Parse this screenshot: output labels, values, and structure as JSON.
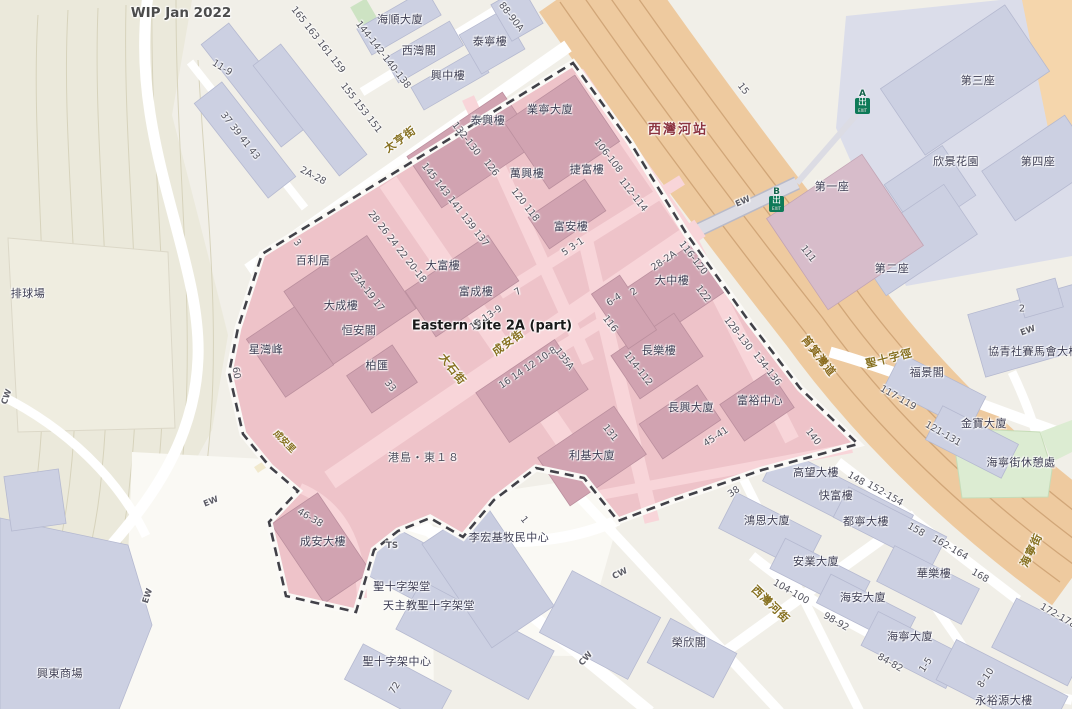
{
  "map": {
    "note": "WIP Jan 2022",
    "site_area": "Eastern Site 2A (part)",
    "station": {
      "name": "西灣河站",
      "exit_glyph": "出",
      "exit_caption": "EXIT",
      "exits": [
        {
          "letter": "A",
          "x": 855,
          "y": 90
        },
        {
          "letter": "B",
          "x": 769,
          "y": 188
        }
      ]
    },
    "colors": {
      "zone_fill": "#eec3c9",
      "zone_building": "#d1a3b1",
      "zone_road": "#f8d5d9",
      "building_lavender": "#ccd0e2",
      "building_mauve": "#d7bcca",
      "corridor_orange": "#eeca9f",
      "park_green": "#dcecd2",
      "hill_beige": "#ebe9db",
      "boundary_dash": "#414148",
      "station_text": "#8c3440",
      "street_text": "#86701f",
      "exit_green": "#0e7a58"
    },
    "labels": [
      {
        "t": "WIP Jan 2022",
        "x": 181,
        "y": 13,
        "c": "note",
        "n": "map-note-wip"
      },
      {
        "t": "11-9",
        "x": 222,
        "y": 68,
        "r": 32,
        "c": "num"
      },
      {
        "t": "165 163 161 159",
        "x": 318,
        "y": 40,
        "r": 52,
        "c": "num"
      },
      {
        "t": "155 153 151",
        "x": 361,
        "y": 108,
        "r": 52,
        "c": "num"
      },
      {
        "t": "37 39 41 43",
        "x": 240,
        "y": 136,
        "r": 52,
        "c": "num"
      },
      {
        "t": "2A-28",
        "x": 313,
        "y": 176,
        "r": 28,
        "c": "num"
      },
      {
        "t": "排球場",
        "x": 28,
        "y": 293,
        "c": "bldg",
        "n": "volleyball-court-label"
      },
      {
        "t": "海順大廈",
        "x": 400,
        "y": 19,
        "c": "bldg"
      },
      {
        "t": "西灣閣",
        "x": 419,
        "y": 50,
        "c": "bldg"
      },
      {
        "t": "泰寧樓",
        "x": 490,
        "y": 41,
        "c": "bldg"
      },
      {
        "t": "興中樓",
        "x": 448,
        "y": 75,
        "c": "bldg"
      },
      {
        "t": "88-90A",
        "x": 511,
        "y": 17,
        "r": 52,
        "c": "num"
      },
      {
        "t": "144-142-140-138",
        "x": 383,
        "y": 55,
        "r": 52,
        "c": "num"
      },
      {
        "t": "太亨街",
        "x": 400,
        "y": 139,
        "r": -36,
        "c": "street",
        "n": "street-tai-hang"
      },
      {
        "t": "泰興樓",
        "x": 488,
        "y": 120,
        "c": "bldg"
      },
      {
        "t": "業寧大廈",
        "x": 550,
        "y": 109,
        "c": "bldg"
      },
      {
        "t": "萬興樓",
        "x": 527,
        "y": 173,
        "c": "bldg"
      },
      {
        "t": "捷富樓",
        "x": 587,
        "y": 169,
        "c": "bldg"
      },
      {
        "t": "富安樓",
        "x": 571,
        "y": 226,
        "c": "bldg"
      },
      {
        "t": "132-130",
        "x": 466,
        "y": 139,
        "r": 52,
        "c": "num"
      },
      {
        "t": "126",
        "x": 491,
        "y": 168,
        "r": 52,
        "c": "num"
      },
      {
        "t": "120 118",
        "x": 525,
        "y": 205,
        "r": 52,
        "c": "num"
      },
      {
        "t": "106-108",
        "x": 608,
        "y": 156,
        "r": 52,
        "c": "num"
      },
      {
        "t": "112-114",
        "x": 633,
        "y": 195,
        "r": 52,
        "c": "num"
      },
      {
        "t": "145 143 141 139 137",
        "x": 455,
        "y": 205,
        "r": 52,
        "c": "num"
      },
      {
        "t": "西灣河站",
        "x": 678,
        "y": 128,
        "c": "station",
        "n": "station-sai-wan-ho"
      },
      {
        "t": "5  3-1",
        "x": 573,
        "y": 247,
        "r": -34,
        "c": "num"
      },
      {
        "t": "大富樓",
        "x": 443,
        "y": 265,
        "c": "bldg"
      },
      {
        "t": "富成樓",
        "x": 476,
        "y": 291,
        "c": "bldg"
      },
      {
        "t": "7",
        "x": 518,
        "y": 292,
        "r": -34,
        "c": "num"
      },
      {
        "t": "28 26 24 22 20-18",
        "x": 397,
        "y": 247,
        "r": 52,
        "c": "num"
      },
      {
        "t": "23A-19 17",
        "x": 367,
        "y": 291,
        "r": 52,
        "c": "num"
      },
      {
        "t": "百利居",
        "x": 313,
        "y": 260,
        "c": "bldg"
      },
      {
        "t": "3",
        "x": 297,
        "y": 243,
        "r": 52,
        "c": "num"
      },
      {
        "t": "大成樓",
        "x": 341,
        "y": 305,
        "c": "bldg"
      },
      {
        "t": "恒安閣",
        "x": 359,
        "y": 330,
        "c": "bldg"
      },
      {
        "t": "星灣峰",
        "x": 266,
        "y": 349,
        "c": "bldg"
      },
      {
        "t": "60",
        "x": 236,
        "y": 373,
        "r": 80,
        "c": "num"
      },
      {
        "t": "柏匯",
        "x": 377,
        "y": 365,
        "c": "bldg"
      },
      {
        "t": "33",
        "x": 390,
        "y": 386,
        "r": 52,
        "c": "num"
      },
      {
        "t": "大石街",
        "x": 453,
        "y": 369,
        "r": 52,
        "c": "street",
        "n": "street-tai-shek"
      },
      {
        "t": "成安街",
        "x": 508,
        "y": 342,
        "r": -36,
        "c": "street",
        "n": "street-shing-on"
      },
      {
        "t": "Eastern Site 2A (part)",
        "x": 492,
        "y": 326,
        "c": "site",
        "n": "site-area-label"
      },
      {
        "t": "15  13-9",
        "x": 486,
        "y": 318,
        "r": -34,
        "c": "num"
      },
      {
        "t": "16 14 12  10-8",
        "x": 528,
        "y": 368,
        "r": -34,
        "c": "num"
      },
      {
        "t": "135A",
        "x": 564,
        "y": 359,
        "r": 52,
        "c": "num"
      },
      {
        "t": "成安里",
        "x": 285,
        "y": 441,
        "r": 46,
        "c": "street-sm",
        "n": "street-shing-on-lane"
      },
      {
        "t": "港島・東１８",
        "x": 424,
        "y": 457,
        "c": "dev",
        "n": "development-island-east-18"
      },
      {
        "t": "利基大廈",
        "x": 592,
        "y": 455,
        "c": "bldg"
      },
      {
        "t": "131",
        "x": 610,
        "y": 433,
        "r": 52,
        "c": "num"
      },
      {
        "t": "28-2A",
        "x": 664,
        "y": 261,
        "r": -34,
        "c": "num"
      },
      {
        "t": "大中樓",
        "x": 672,
        "y": 280,
        "c": "bldg"
      },
      {
        "t": "116-120",
        "x": 693,
        "y": 258,
        "r": 52,
        "c": "num"
      },
      {
        "t": "122",
        "x": 703,
        "y": 294,
        "r": 52,
        "c": "num"
      },
      {
        "t": "6-4",
        "x": 614,
        "y": 300,
        "r": -34,
        "c": "num"
      },
      {
        "t": "2",
        "x": 634,
        "y": 292,
        "r": -34,
        "c": "num"
      },
      {
        "t": "116",
        "x": 610,
        "y": 324,
        "r": 52,
        "c": "num"
      },
      {
        "t": "長樂樓",
        "x": 659,
        "y": 350,
        "c": "bldg"
      },
      {
        "t": "114-112",
        "x": 638,
        "y": 369,
        "r": 52,
        "c": "num"
      },
      {
        "t": "128-130",
        "x": 738,
        "y": 334,
        "r": 52,
        "c": "num"
      },
      {
        "t": "134-136",
        "x": 767,
        "y": 369,
        "r": 52,
        "c": "num"
      },
      {
        "t": "富裕中心",
        "x": 760,
        "y": 400,
        "c": "bldg"
      },
      {
        "t": "長興大廈",
        "x": 691,
        "y": 407,
        "c": "bldg"
      },
      {
        "t": "45-41",
        "x": 716,
        "y": 437,
        "r": -34,
        "c": "num"
      },
      {
        "t": "第一座",
        "x": 832,
        "y": 186,
        "c": "bldg"
      },
      {
        "t": "111",
        "x": 808,
        "y": 254,
        "r": 52,
        "c": "num"
      },
      {
        "t": "第二座",
        "x": 892,
        "y": 268,
        "c": "bldg"
      },
      {
        "t": "第三座",
        "x": 978,
        "y": 80,
        "c": "bldg"
      },
      {
        "t": "欣景花園",
        "x": 956,
        "y": 161,
        "c": "bldg"
      },
      {
        "t": "第四座",
        "x": 1038,
        "y": 161,
        "c": "bldg"
      },
      {
        "t": "15",
        "x": 743,
        "y": 89,
        "r": 52,
        "c": "num"
      },
      {
        "t": "EW",
        "x": 743,
        "y": 202,
        "r": -24,
        "c": "small"
      },
      {
        "t": "筲箕灣道",
        "x": 819,
        "y": 356,
        "r": 52,
        "c": "ostreet",
        "n": "street-shau-kei-wan-road"
      },
      {
        "t": "聖十字徑",
        "x": 889,
        "y": 358,
        "r": -14,
        "c": "street",
        "n": "street-holy-cross-path"
      },
      {
        "t": "福景閣",
        "x": 927,
        "y": 372,
        "c": "bldg"
      },
      {
        "t": "協青社賽馬會大樓",
        "x": 1034,
        "y": 351,
        "c": "bldg"
      },
      {
        "t": "2",
        "x": 1022,
        "y": 309,
        "c": "num"
      },
      {
        "t": "EW",
        "x": 1028,
        "y": 331,
        "r": -20,
        "c": "small"
      },
      {
        "t": "117-119",
        "x": 898,
        "y": 398,
        "r": 30,
        "c": "num"
      },
      {
        "t": "121-131",
        "x": 943,
        "y": 434,
        "r": 30,
        "c": "num"
      },
      {
        "t": "金寶大廈",
        "x": 984,
        "y": 423,
        "c": "bldg"
      },
      {
        "t": "海寧街休憩處",
        "x": 1021,
        "y": 462,
        "c": "bldg",
        "n": "park-label"
      },
      {
        "t": "海寧街",
        "x": 1031,
        "y": 550,
        "r": -64,
        "c": "street",
        "n": "street-hoi-ning"
      },
      {
        "t": "140",
        "x": 813,
        "y": 437,
        "r": 52,
        "c": "num"
      },
      {
        "t": "高望大樓",
        "x": 816,
        "y": 472,
        "c": "bldg"
      },
      {
        "t": "148",
        "x": 856,
        "y": 479,
        "r": 30,
        "c": "num"
      },
      {
        "t": "快富樓",
        "x": 836,
        "y": 495,
        "c": "bldg"
      },
      {
        "t": "38",
        "x": 734,
        "y": 492,
        "r": -34,
        "c": "num"
      },
      {
        "t": "鴻恩大廈",
        "x": 767,
        "y": 520,
        "c": "bldg"
      },
      {
        "t": "都寧大樓",
        "x": 866,
        "y": 521,
        "c": "bldg"
      },
      {
        "t": "152-154",
        "x": 885,
        "y": 494,
        "r": 30,
        "c": "num"
      },
      {
        "t": "158",
        "x": 916,
        "y": 530,
        "r": 30,
        "c": "num"
      },
      {
        "t": "162-164",
        "x": 950,
        "y": 548,
        "r": 30,
        "c": "num"
      },
      {
        "t": "168",
        "x": 980,
        "y": 576,
        "r": 30,
        "c": "num"
      },
      {
        "t": "安業大廈",
        "x": 816,
        "y": 561,
        "c": "bldg"
      },
      {
        "t": "華樂樓",
        "x": 934,
        "y": 573,
        "c": "bldg"
      },
      {
        "t": "104-100",
        "x": 791,
        "y": 592,
        "r": 30,
        "c": "num"
      },
      {
        "t": "98-92",
        "x": 836,
        "y": 622,
        "r": 30,
        "c": "num"
      },
      {
        "t": "海安大廈",
        "x": 863,
        "y": 597,
        "c": "bldg"
      },
      {
        "t": "海寧大廈",
        "x": 910,
        "y": 636,
        "c": "bldg"
      },
      {
        "t": "84-82",
        "x": 890,
        "y": 663,
        "r": 30,
        "c": "num"
      },
      {
        "t": "1-5",
        "x": 926,
        "y": 665,
        "r": -56,
        "c": "num"
      },
      {
        "t": "8-10",
        "x": 986,
        "y": 678,
        "r": -56,
        "c": "num"
      },
      {
        "t": "永裕源大樓",
        "x": 1004,
        "y": 700,
        "c": "bldg"
      },
      {
        "t": "172-178",
        "x": 1058,
        "y": 616,
        "r": 30,
        "c": "num"
      },
      {
        "t": "西灣河街",
        "x": 771,
        "y": 604,
        "r": 44,
        "c": "street",
        "n": "street-sai-wan-ho"
      },
      {
        "t": "成安大樓",
        "x": 323,
        "y": 541,
        "c": "bldg"
      },
      {
        "t": "46-38",
        "x": 310,
        "y": 518,
        "r": 30,
        "c": "num"
      },
      {
        "t": "TS",
        "x": 392,
        "y": 546,
        "c": "small"
      },
      {
        "t": "李宏基牧民中心",
        "x": 509,
        "y": 537,
        "c": "bldg"
      },
      {
        "t": "1",
        "x": 524,
        "y": 520,
        "r": 52,
        "c": "num"
      },
      {
        "t": "聖十字架堂",
        "x": 402,
        "y": 586,
        "c": "bldg"
      },
      {
        "t": "天主教聖十字架堂",
        "x": 429,
        "y": 605,
        "c": "bldg"
      },
      {
        "t": "聖十字架中心",
        "x": 397,
        "y": 661,
        "c": "bldg"
      },
      {
        "t": "榮欣閣",
        "x": 689,
        "y": 642,
        "c": "bldg"
      },
      {
        "t": "CW",
        "x": 620,
        "y": 574,
        "r": -26,
        "c": "small"
      },
      {
        "t": "CW",
        "x": 586,
        "y": 659,
        "r": -48,
        "c": "small"
      },
      {
        "t": "72",
        "x": 395,
        "y": 688,
        "r": -58,
        "c": "num"
      },
      {
        "t": "興東商場",
        "x": 60,
        "y": 673,
        "c": "bldg",
        "n": "mall-hing-tung-label"
      },
      {
        "t": "EW",
        "x": 211,
        "y": 502,
        "r": -22,
        "c": "small"
      },
      {
        "t": "EW",
        "x": 148,
        "y": 596,
        "r": -72,
        "c": "small"
      },
      {
        "t": "CW",
        "x": 7,
        "y": 397,
        "r": -70,
        "c": "small"
      }
    ]
  }
}
